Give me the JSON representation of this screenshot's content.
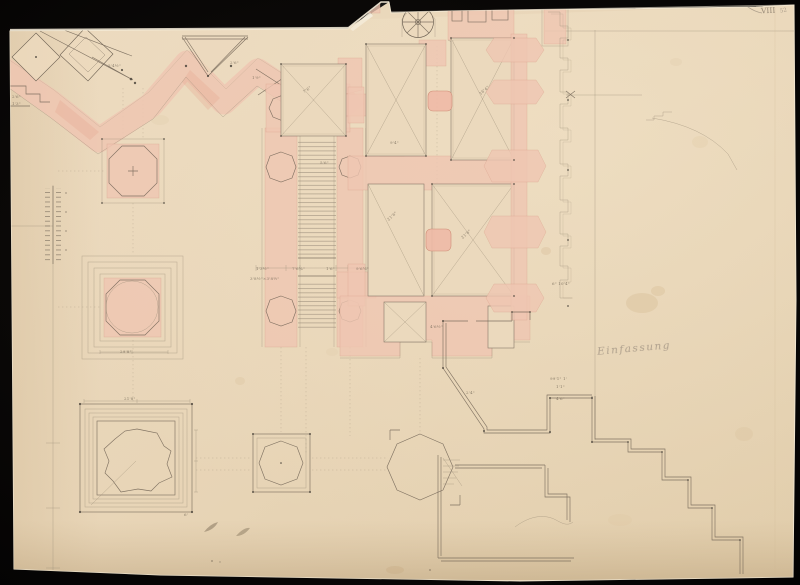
{
  "scene": {
    "description": "Historical architectural floor-plan drawing in graphite and pink wash on cream laid paper with torn edges, photographed on a black background"
  },
  "palette": {
    "background": "#0a0807",
    "paper": "#e8d5b8",
    "paper_highlight": "#f6edda",
    "pink_wash": "#efc5b2",
    "pink_deep": "#e5a78f",
    "graphite": "#9b8d78",
    "ink": "#6e6254",
    "stain": "#d8bd97"
  },
  "marks": {
    "sheet_mark": "VIII",
    "sheet_note": "52",
    "cursive_note": "Einfassung",
    "dim_labels": [
      {
        "t": "5'4½\"",
        "x": 108,
        "y": 63
      },
      {
        "t": "2'6\"",
        "x": 230,
        "y": 60
      },
      {
        "t": "1'9\"",
        "x": 252,
        "y": 75
      },
      {
        "t": "7'6\"",
        "x": 302,
        "y": 90,
        "r": -35
      },
      {
        "t": "16'4\"",
        "x": 478,
        "y": 92,
        "r": -40
      },
      {
        "t": "9'4\"",
        "x": 390,
        "y": 140
      },
      {
        "t": "5'6\"",
        "x": 320,
        "y": 160
      },
      {
        "t": "21'6\"",
        "x": 386,
        "y": 218,
        "r": -42
      },
      {
        "t": "21'6\"",
        "x": 460,
        "y": 236,
        "r": -42
      },
      {
        "t": "6\" 10'4\"",
        "x": 552,
        "y": 281
      },
      {
        "t": "1'3½\"",
        "x": 256,
        "y": 266
      },
      {
        "t": "7'6¾\"",
        "x": 292,
        "y": 266
      },
      {
        "t": "1'6\"",
        "x": 326,
        "y": 266
      },
      {
        "t": "9'6¾\"",
        "x": 356,
        "y": 266
      },
      {
        "t": "3'8½\"×3'8½\"",
        "x": 250,
        "y": 276
      },
      {
        "t": "4'6½\"",
        "x": 430,
        "y": 324
      },
      {
        "t": "29'8\"",
        "x": 120,
        "y": 349
      },
      {
        "t": "21'8\"",
        "x": 124,
        "y": 396
      },
      {
        "t": "2'6\"",
        "x": 12,
        "y": 94
      },
      {
        "t": "1'3\"",
        "x": 12,
        "y": 101
      },
      {
        "t": "99'1\" 1'",
        "x": 550,
        "y": 376
      },
      {
        "t": "1'1\"",
        "x": 556,
        "y": 384
      },
      {
        "t": "4'6\"",
        "x": 556,
        "y": 396
      },
      {
        "t": "2'4\"",
        "x": 466,
        "y": 390
      },
      {
        "t": "6'",
        "x": 184,
        "y": 512
      }
    ]
  }
}
